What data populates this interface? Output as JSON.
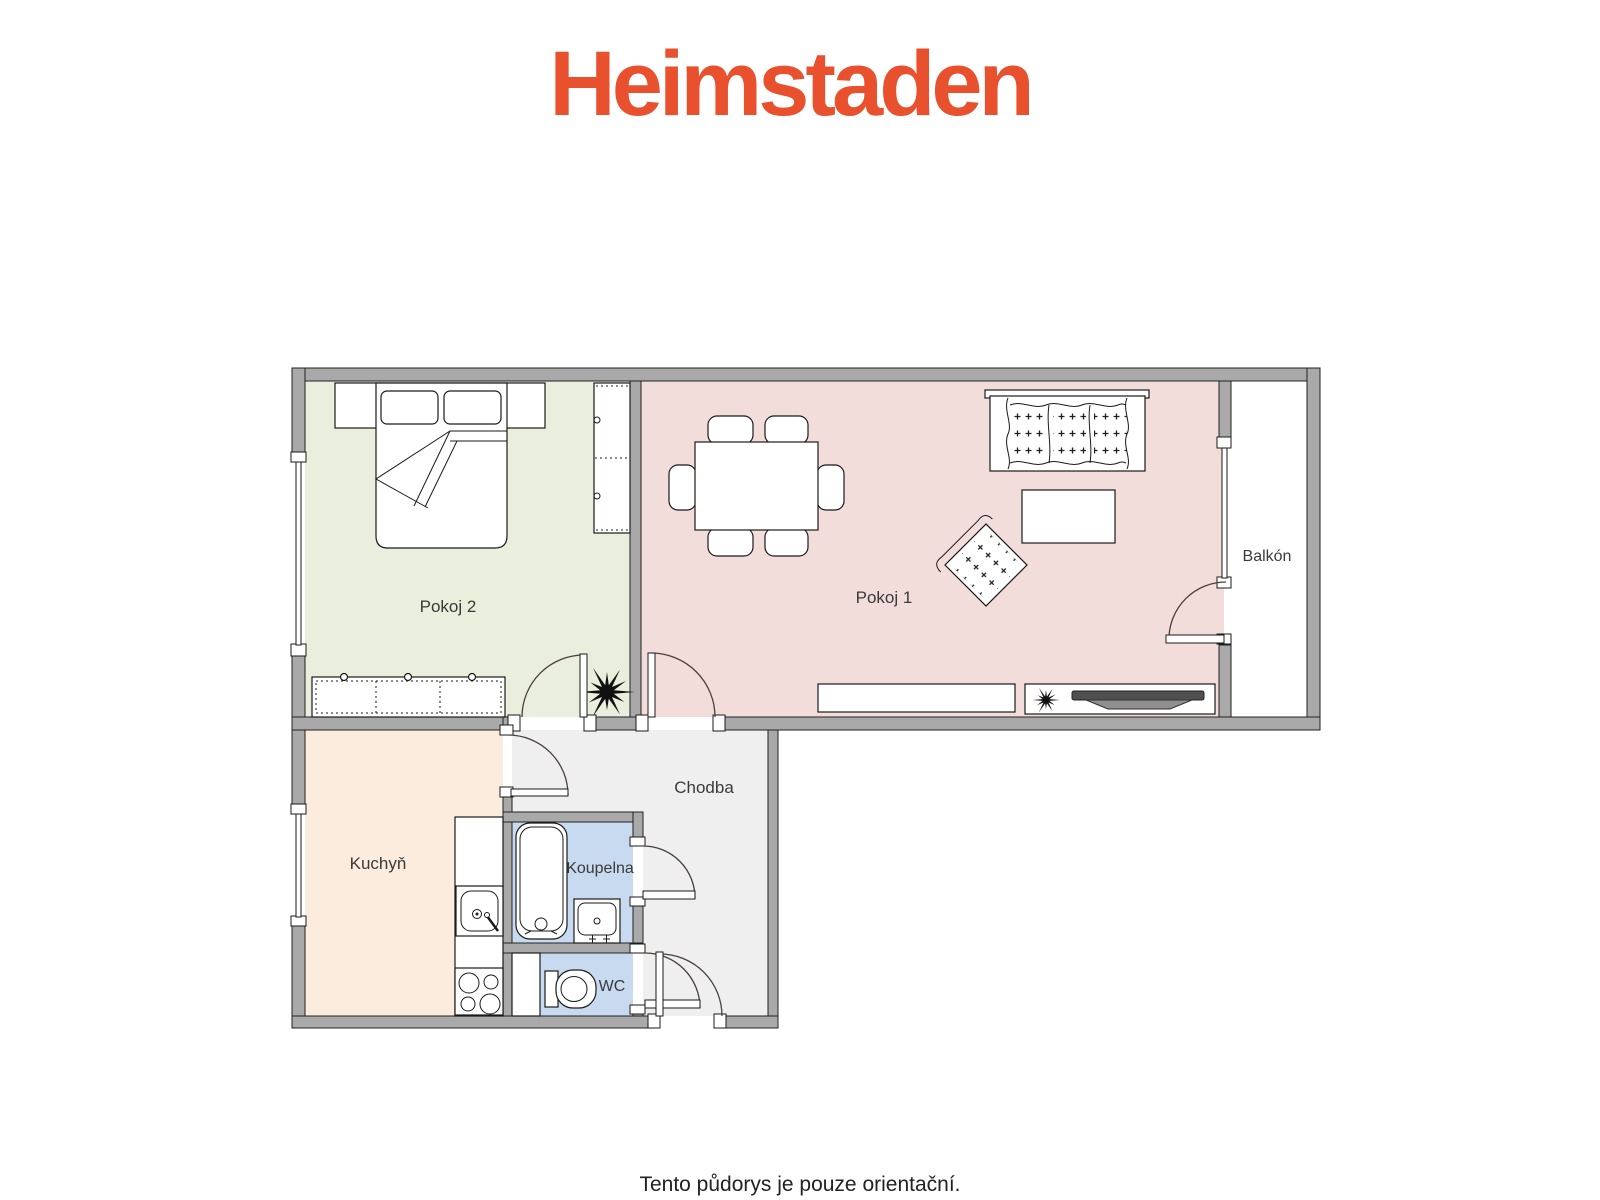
{
  "logo": {
    "text": "Heimstaden",
    "color": "#E9502D"
  },
  "footer": {
    "disclaimer": "Tento půdorys je pouze orientační."
  },
  "plan": {
    "colors": {
      "wall": "#a9a9a9",
      "outline": "#1a1a1a",
      "door_arc": "#4a3f3a"
    },
    "rooms": [
      {
        "id": "pokoj2",
        "label": "Pokoj 2",
        "fill": "#e9eedd",
        "furniture": [
          "bed",
          "pillows",
          "headboard",
          "wardrobe",
          "dresser",
          "plant"
        ]
      },
      {
        "id": "pokoj1",
        "label": "Pokoj 1",
        "fill": "#f2dddb",
        "furniture": [
          "dining-table",
          "chairs",
          "sofa",
          "coffee-table",
          "armchair",
          "sideboard",
          "tv-cabinet",
          "tv"
        ]
      },
      {
        "id": "balkon",
        "label": "Balkón",
        "fill": "#ffffff",
        "furniture": []
      },
      {
        "id": "kuchyn",
        "label": "Kuchyň",
        "fill": "#fcecdd",
        "furniture": [
          "counter",
          "kitchen-sink",
          "stove"
        ]
      },
      {
        "id": "chodba",
        "label": "Chodba",
        "fill": "#efefef",
        "furniture": []
      },
      {
        "id": "koupelna",
        "label": "Koupelna",
        "fill": "#c8daf0",
        "furniture": [
          "bathtub",
          "washbasin"
        ]
      },
      {
        "id": "wc",
        "label": "WC",
        "fill": "#c8daf0",
        "furniture": [
          "toilet"
        ]
      }
    ]
  }
}
